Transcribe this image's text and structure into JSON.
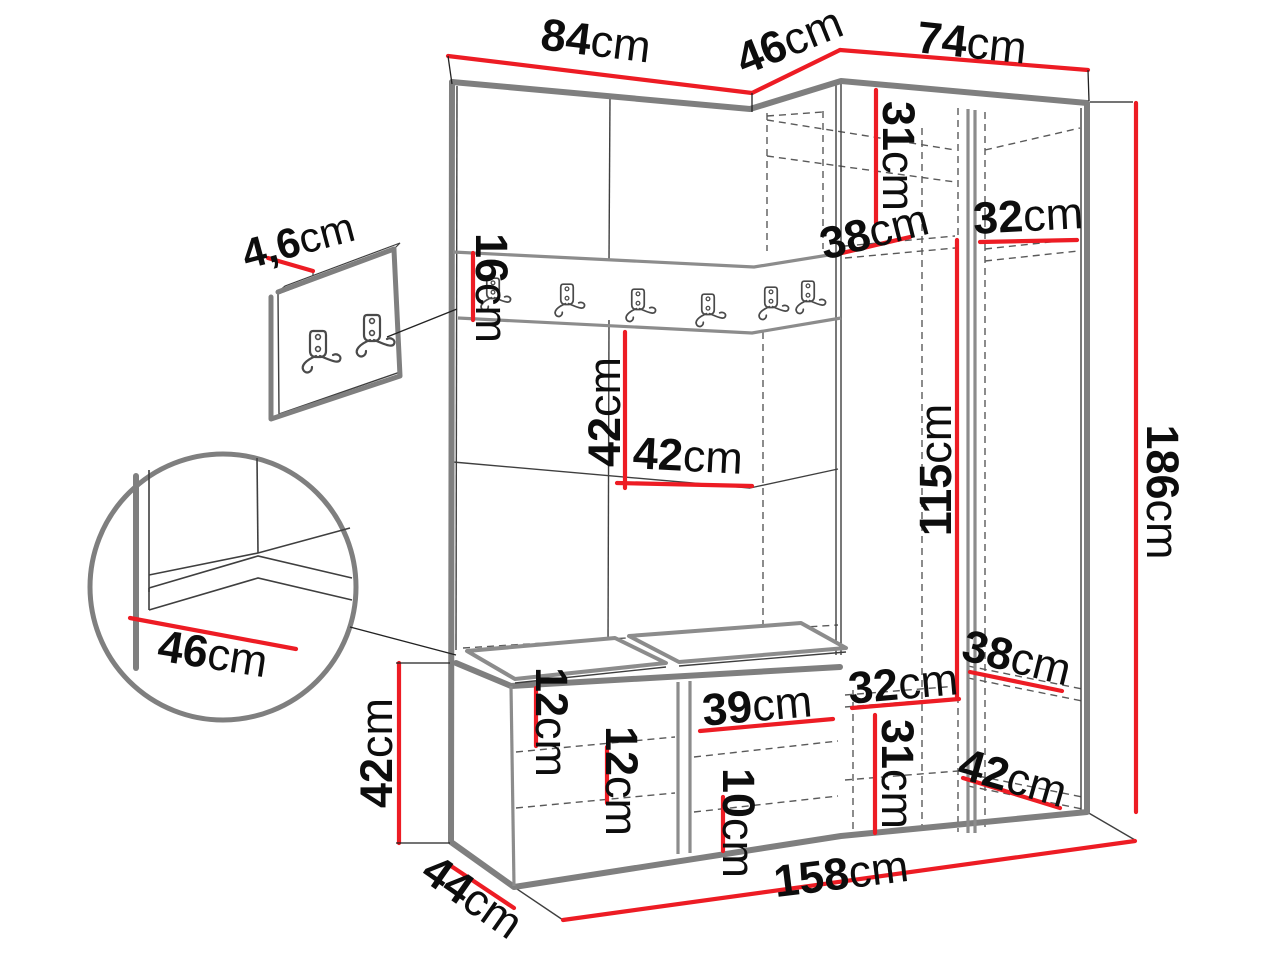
{
  "diagram": {
    "kind": "furniture dimension drawing",
    "unit_suffix": "cm",
    "accent_color": "#ed1c24",
    "outline_color": "#7f7f7f",
    "text_color": "#0d0d0d"
  },
  "dims": {
    "d84": {
      "num": "84",
      "unit": "cm"
    },
    "d46": {
      "num": "46",
      "unit": "cm"
    },
    "d74": {
      "num": "74",
      "unit": "cm"
    },
    "d31t": {
      "num": "31",
      "unit": "cm"
    },
    "d38t": {
      "num": "38",
      "unit": "cm"
    },
    "d32t": {
      "num": "32",
      "unit": "cm"
    },
    "d16": {
      "num": "16",
      "unit": "cm"
    },
    "d42mv": {
      "num": "42",
      "unit": "cm"
    },
    "d42mh": {
      "num": "42",
      "unit": "cm"
    },
    "d115": {
      "num": "115",
      "unit": "cm"
    },
    "d186": {
      "num": "186",
      "unit": "cm"
    },
    "d32b": {
      "num": "32",
      "unit": "cm"
    },
    "d38b": {
      "num": "38",
      "unit": "cm"
    },
    "d31b": {
      "num": "31",
      "unit": "cm"
    },
    "d42br": {
      "num": "42",
      "unit": "cm"
    },
    "d39": {
      "num": "39",
      "unit": "cm"
    },
    "d12a": {
      "num": "12",
      "unit": "cm"
    },
    "d12b": {
      "num": "12",
      "unit": "cm"
    },
    "d10": {
      "num": "10",
      "unit": "cm"
    },
    "d42l": {
      "num": "42",
      "unit": "cm"
    },
    "d44": {
      "num": "44",
      "unit": "cm"
    },
    "d158": {
      "num": "158",
      "unit": "cm"
    },
    "d46c": {
      "num": "46",
      "unit": "cm"
    },
    "d46p": {
      "num": "4,6",
      "unit": "cm"
    }
  }
}
